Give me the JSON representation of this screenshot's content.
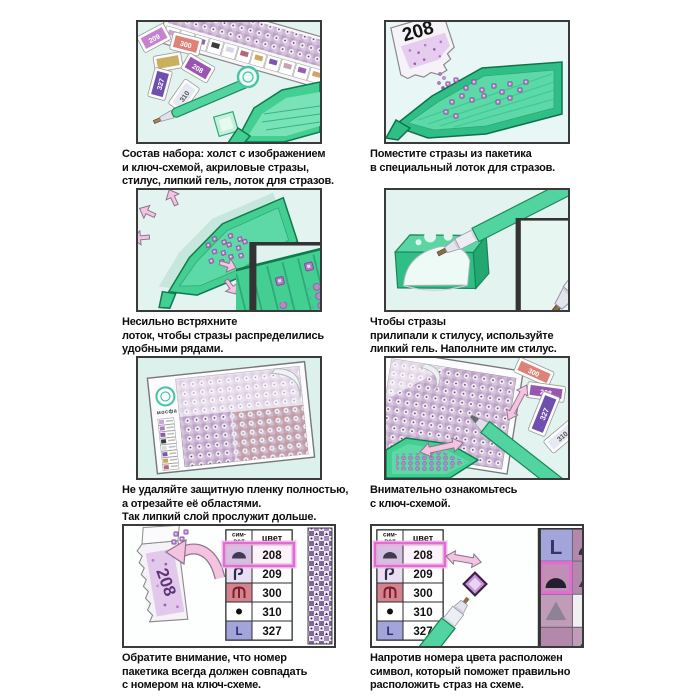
{
  "steps": [
    {
      "caption": [
        "Состав набора: холст с изображением",
        "и ключ-схемой, акриловые стразы,",
        "стилус, липкий гель, лоток для стразов."
      ]
    },
    {
      "caption": [
        "Поместите стразы из пакетика",
        "в специальный лоток для стразов."
      ]
    },
    {
      "caption": [
        "Несильно встряхните",
        "лоток, чтобы стразы распределились",
        "удобными рядами."
      ]
    },
    {
      "caption": [
        "Чтобы стразы",
        "прилипали к стилусу, используйте",
        "липкий гель. Наполните им стилус."
      ]
    },
    {
      "caption": [
        "Не удаляйте защитную пленку полностью,",
        "а отрезайте её областями.",
        "Так липкий слой прослужит дольше."
      ]
    },
    {
      "caption": [
        "Внимательно ознакомьтесь",
        "с ключ-схемой."
      ]
    },
    {
      "caption": [
        "Обратите внимание, что номер",
        "пакетика всегда должен совпадать",
        "с номером на ключ-схеме."
      ]
    },
    {
      "caption": [
        "Напротив номера цвета расположен",
        "символ, который поможет правильно",
        "расположить страз на схеме."
      ]
    }
  ],
  "packets": {
    "p208": "208",
    "p209": "209",
    "p300": "300",
    "p310": "310",
    "p327": "327"
  },
  "brand": {
    "logo_text": "мосфа"
  },
  "key_table": {
    "header_symbol_line1": "сим-",
    "header_symbol_line2": "вол",
    "header_color": "цвет",
    "rows": [
      {
        "code": "208",
        "symbol": "dome"
      },
      {
        "code": "209",
        "symbol": "hook"
      },
      {
        "code": "300",
        "symbol": "trident"
      },
      {
        "code": "310",
        "symbol": "dot"
      },
      {
        "code": "327",
        "symbol": "letter-L",
        "glyph": "L"
      }
    ],
    "highlighted_code": "208"
  },
  "colors": {
    "green": "#44cf92",
    "green_dark": "#0e7a4e",
    "mint_panel": "#e3f3ef",
    "pink_arrow": "#f3c3e0",
    "stone_purple": "#b279c9",
    "highlight_magenta": "#e36bd3",
    "panel_border": "#3a3a3a"
  }
}
